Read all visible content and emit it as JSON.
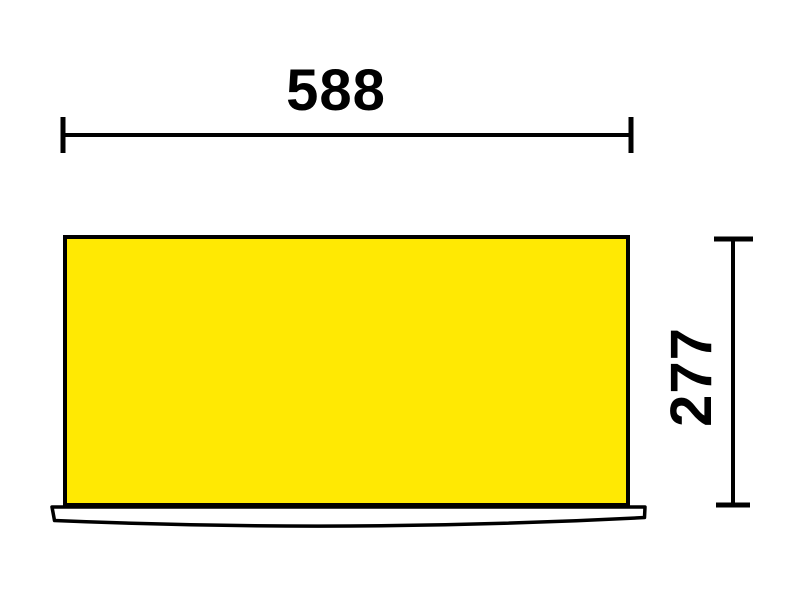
{
  "drawing": {
    "type": "technical-dimension-drawing",
    "width_dimension": {
      "label": "588"
    },
    "height_dimension": {
      "label": "277"
    },
    "colors": {
      "panel_fill": "#FFE903",
      "line": "#000000",
      "background": "#FFFFFF"
    }
  }
}
